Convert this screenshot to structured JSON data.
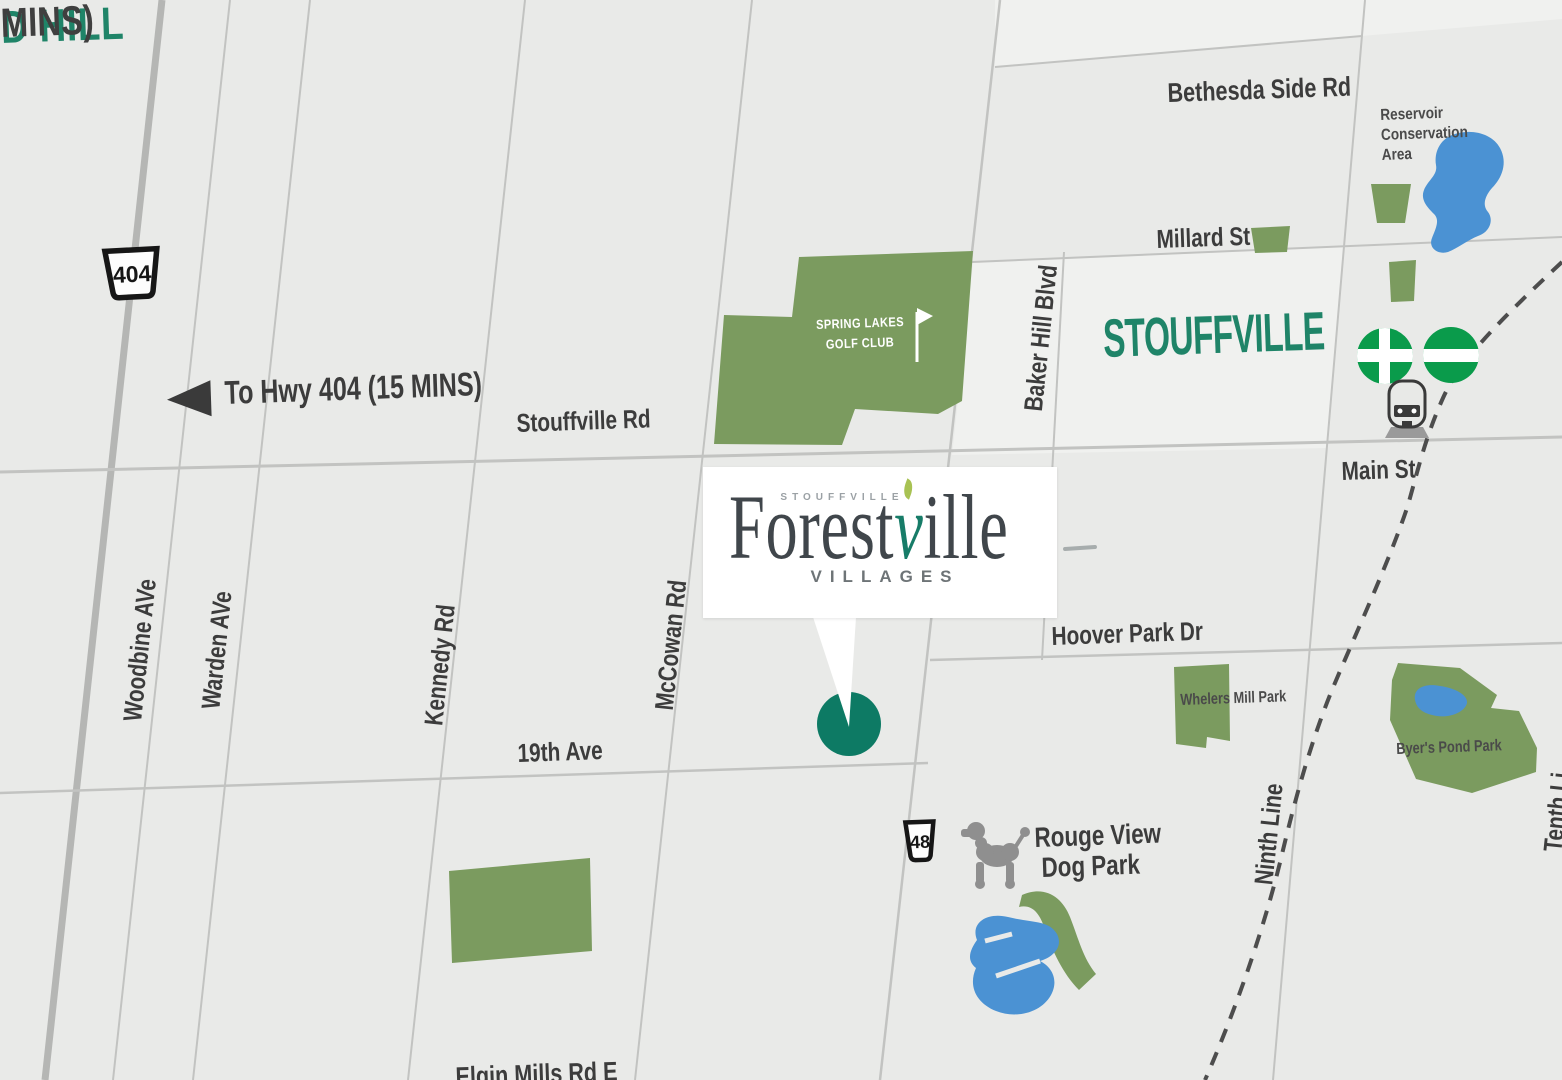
{
  "colors": {
    "background": "#e9eae8",
    "light_block": "#f0f1ef",
    "road": "#c2c3c1",
    "highway_road": "#b5b6b4",
    "park_green": "#7b9b5f",
    "water_blue": "#4b92d3",
    "teal_text": "#1f8468",
    "dark_text": "#3c3c3c",
    "muted_text": "#4a4a4a",
    "marker_teal": "#0d7a64",
    "go_green": "#0a9b4b",
    "icon_gray": "#8f8f8f",
    "rail_gray": "#4d4d4d",
    "white": "#ffffff"
  },
  "region": {
    "city_left_partial": "D HILL",
    "city_left_minutes_partial": "MINS)",
    "city_main": "STOUFFVILLE",
    "bottom_road_partial": "Elgin Mills Rd E"
  },
  "highways": {
    "shield_404": "404",
    "shield_48": "48",
    "direction_label": "To Hwy 404 (15 MINS)"
  },
  "roads": {
    "stouffville_rd": "Stouffville Rd",
    "nineteenth_ave": "19th Ave",
    "bethesda_side_rd": "Bethesda Side Rd",
    "millard_st": "Millard St",
    "main_st": "Main St",
    "hoover_park_dr": "Hoover Park Dr",
    "woodbine_ave": "Woodbine AVe",
    "warden_ave": "Warden AVe",
    "kennedy_rd": "Kennedy Rd",
    "mccowan_rd": "McCowan Rd",
    "baker_hill_blvd": "Baker Hill Blvd",
    "ninth_line": "Ninth Line",
    "tenth_line_partial": "Tenth Li"
  },
  "parks": {
    "golf_line1": "SPRING LAKES",
    "golf_line2": "GOLF CLUB",
    "whelers": "Whelers Mill Park",
    "byers": "Byer's Pond Park",
    "dog_park_line1": "Rouge View",
    "dog_park_line2": "Dog Park",
    "reservoir_line1": "Reservoir",
    "reservoir_line2": "Conservation",
    "reservoir_line3": "Area"
  },
  "icons": {
    "go_logo": "go-transit-logo",
    "train": "train-icon",
    "dog": "dog-icon",
    "golf_flag": "golf-flag-icon",
    "left_arrow": "left-arrow-icon",
    "marker": "location-marker",
    "railway": "railway-dashed-line"
  },
  "logo": {
    "eyebrow": "STOUFFVILLE",
    "name_pre": "Forest",
    "name_leaf": "v",
    "name_post": "ille",
    "tagline": "VILLAGES"
  }
}
